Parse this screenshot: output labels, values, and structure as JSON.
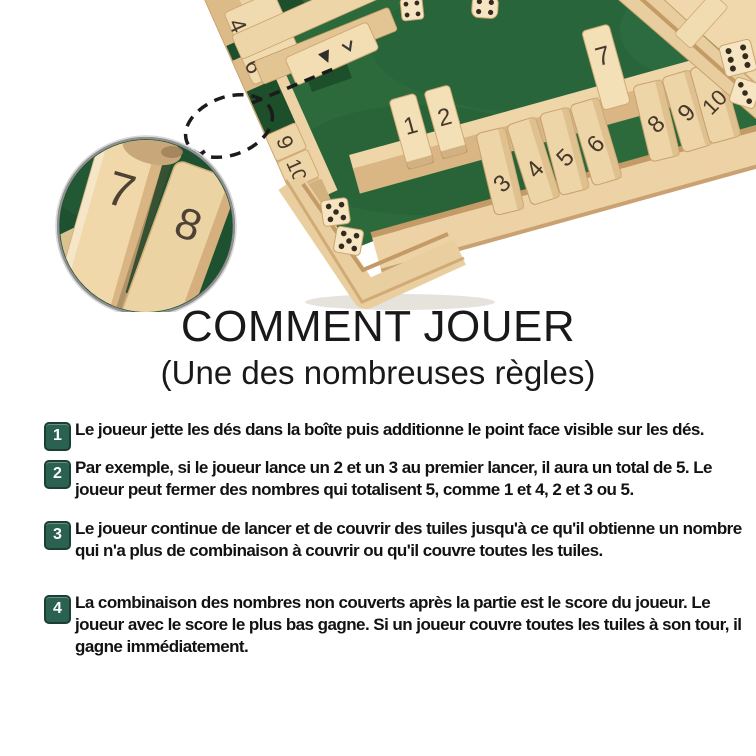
{
  "title": {
    "heading": "COMMENT JOUER",
    "subheading": "(Une des nombreuses règles)"
  },
  "steps": [
    {
      "number": "1",
      "text": "Le joueur jette les dés dans la boîte puis additionne le point face visible sur les dés."
    },
    {
      "number": "2",
      "text": "Par exemple, si le joueur lance un 2 et un 3 au premier lancer, il aura un total de 5. Le joueur peut fermer des nombres qui totalisent 5, comme 1 et 4, 2 et 3 ou 5."
    },
    {
      "number": "3",
      "text": "Le joueur continue de lancer et de couvrir des tuiles jusqu'à ce qu'il obtienne un nombre qui n'a plus de combinaison à couvrir ou qu'il couvre toutes les tuiles."
    },
    {
      "number": "4",
      "text": "La combinaison des nombres non couverts après la partie est le score du joueur. Le joueur avec le score le plus bas gagne. Si un joueur couvre toutes les tuiles à son tour, il gagne immédiatement."
    }
  ],
  "photo": {
    "board": {
      "left_rail_tiles": [
        "4",
        "6",
        "9",
        "10"
      ],
      "bottom_rail_tiles": [
        "1",
        "2",
        "3",
        "4",
        "5",
        "6",
        "7",
        "8",
        "9",
        "10"
      ],
      "open_tiles": [
        "1",
        "2",
        "7"
      ],
      "dice_pips": [
        4,
        4,
        6,
        3,
        5,
        5
      ]
    },
    "magnifier": {
      "tiles": [
        "7",
        "8"
      ]
    },
    "colors": {
      "felt_green": "#2c6a3c",
      "wood_light": "#f3e0b6",
      "wood_mid": "#dcbb88",
      "badge_green": "#2a6150",
      "tile_number": "#46392b"
    }
  }
}
